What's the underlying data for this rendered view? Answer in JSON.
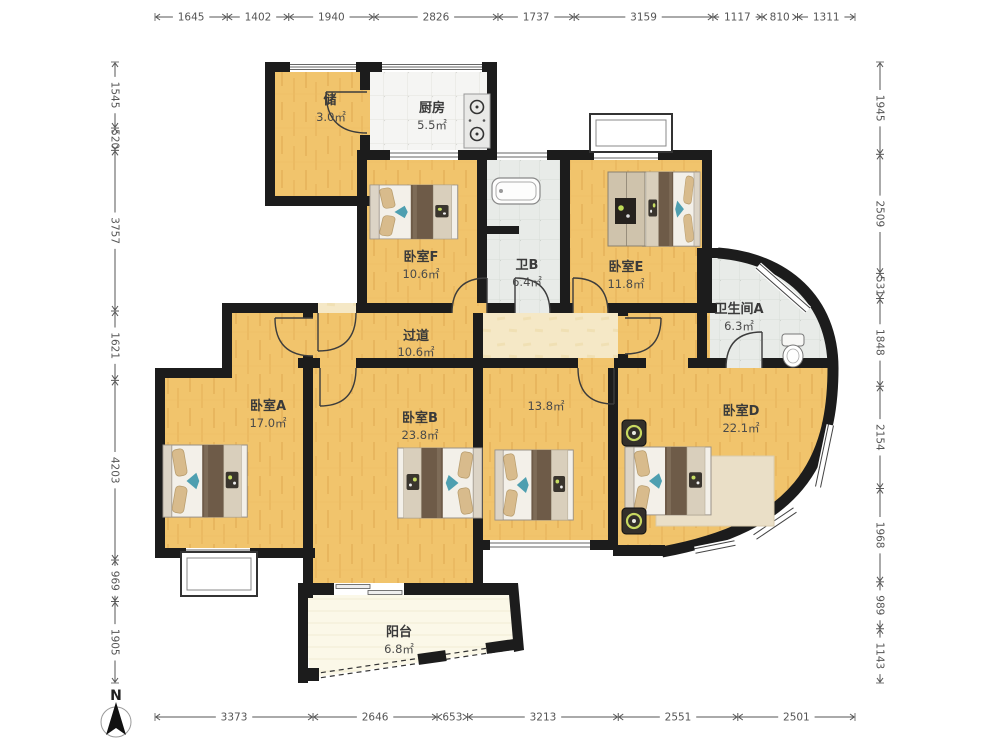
{
  "plan": {
    "compass_label": "N",
    "rooms": [
      {
        "id": "storage",
        "name": "储",
        "area": "3.0㎡"
      },
      {
        "id": "kitchen",
        "name": "厨房",
        "area": "5.5㎡"
      },
      {
        "id": "bedroom_f",
        "name": "卧室F",
        "area": "10.6㎡"
      },
      {
        "id": "bath_b",
        "name": "卫B",
        "area": "6.4㎡"
      },
      {
        "id": "bedroom_e",
        "name": "卧室E",
        "area": "11.8㎡"
      },
      {
        "id": "bath_a",
        "name": "卫生间A",
        "area": "6.3㎡"
      },
      {
        "id": "hallway",
        "name": "过道",
        "area": "10.6㎡"
      },
      {
        "id": "bedroom_a",
        "name": "卧室A",
        "area": "17.0㎡"
      },
      {
        "id": "bedroom_b",
        "name": "卧室B",
        "area": "23.8㎡"
      },
      {
        "id": "room_138",
        "name": "",
        "area": "13.8㎡"
      },
      {
        "id": "bedroom_d",
        "name": "卧室D",
        "area": "22.1㎡"
      },
      {
        "id": "balcony",
        "name": "阳台",
        "area": "6.8㎡"
      }
    ],
    "dimensions": {
      "top": [
        1645,
        1402,
        1940,
        2826,
        1737,
        3159,
        1117,
        810,
        1311
      ],
      "left": [
        1545,
        520,
        3757,
        1621,
        4203,
        969,
        1905
      ],
      "right": [
        1945,
        2509,
        531,
        1848,
        2154,
        1968,
        989,
        1143
      ],
      "bottom": [
        3373,
        2646,
        653,
        3213,
        2551,
        2501
      ]
    },
    "colors": {
      "wall": "#1c1c1c",
      "wood": "#F1C46C",
      "hallway": "#F5E8C6",
      "tile_kitchen": "#F5F5F3",
      "tile_bath": "#E7EAE7",
      "balcony": "#FBF8E8",
      "dim_text": "#555555"
    }
  }
}
